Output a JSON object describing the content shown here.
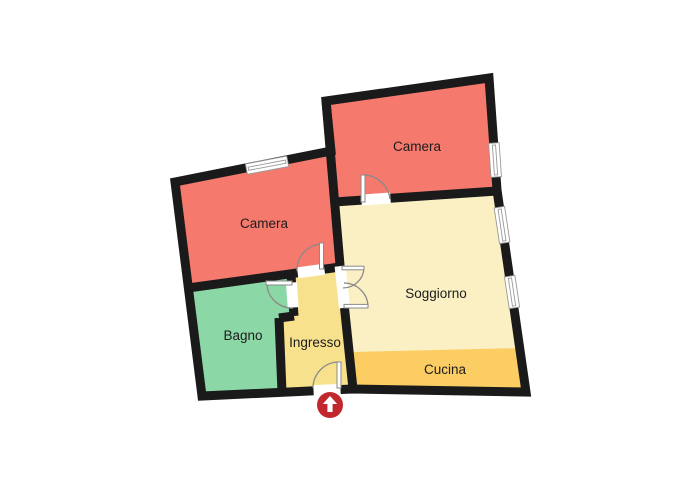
{
  "floorplan": {
    "background_color": "#ffffff",
    "wall_color": "#1a1a1a",
    "door_frame_color": "#8a8a8a",
    "rooms": [
      {
        "id": "camera-top",
        "label": "Camera",
        "color": "#f5796d"
      },
      {
        "id": "camera-left",
        "label": "Camera",
        "color": "#f5796d"
      },
      {
        "id": "soggiorno",
        "label": "Soggiorno",
        "color": "#faf0c4"
      },
      {
        "id": "cucina",
        "label": "Cucina",
        "color": "#fbcd63"
      },
      {
        "id": "bagno",
        "label": "Bagno",
        "color": "#8cd7a6"
      },
      {
        "id": "ingresso",
        "label": "Ingresso",
        "color": "#f7e18c"
      }
    ],
    "entrance_marker": {
      "color": "#c1272d",
      "icon": "up-arrow"
    }
  }
}
